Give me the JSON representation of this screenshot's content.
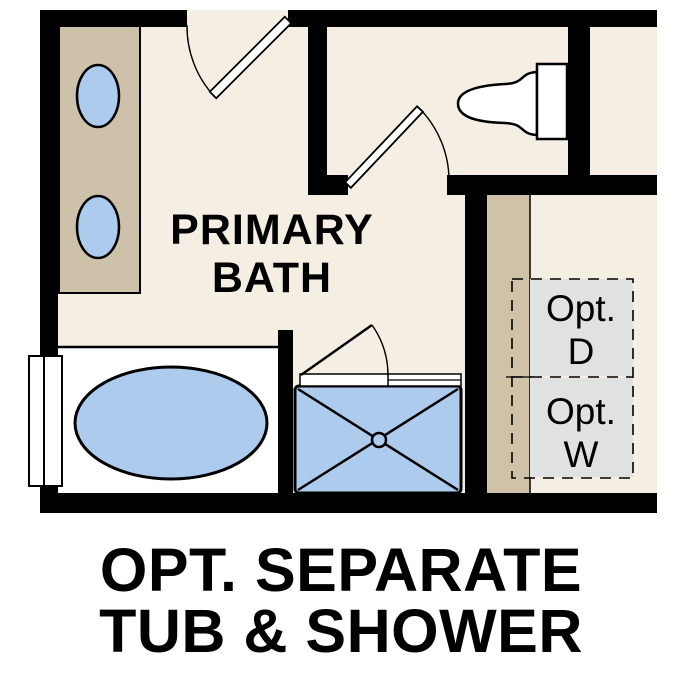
{
  "plan": {
    "room": {
      "label_line1": "PRIMARY",
      "label_line2": "BATH"
    },
    "optional_dryer": {
      "label_line1": "Opt.",
      "label_line2": "D"
    },
    "optional_washer": {
      "label_line1": "Opt.",
      "label_line2": "W"
    },
    "fixtures": {
      "vanity": "double-sink vanity",
      "toilet": "toilet",
      "window": "window",
      "tub": "soaking tub",
      "shower": "walk-in shower with swing door"
    }
  },
  "caption": {
    "line1": "OPT. SEPARATE",
    "line2": "TUB & SHOWER"
  },
  "colors": {
    "wall_black": "#000000",
    "floor_cream": "#f5eee2",
    "cabinet_tan": "#cdc2a9",
    "chase_tan": "#cfc2a7",
    "fixture_blue": "#adcbed",
    "optional_gray": "#e0e2e1",
    "fixture_white": "#ffffff",
    "text_black": "#000000"
  }
}
